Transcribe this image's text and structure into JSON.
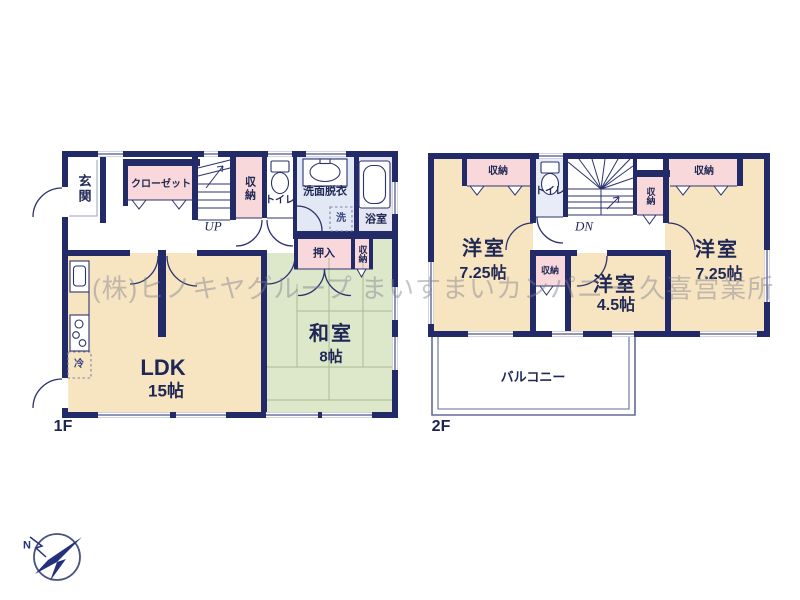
{
  "watermark": "(株)ヒノキヤグループ まいすまいカンパニー 久喜営業所",
  "compass": {
    "north_label": "N"
  },
  "colors": {
    "wall": "#232a68",
    "room_beige": "#f7e5c1",
    "tatami_green": "#dde8cb",
    "closet_pink": "#f8d8da",
    "wet_blue": "#e2e9f4",
    "bath_lavender": "#e5e6f1",
    "balcony_line": "#646b96",
    "watermark_gray": "rgba(125,127,142,0.45)"
  },
  "floor1": {
    "label": "1F",
    "rooms": {
      "genkan": "玄関",
      "closet": "クローゼット",
      "stairs_up": "UP",
      "storage_hall": "収納",
      "toilet": "トイレ",
      "washroom": "洗面脱衣",
      "washer": "洗",
      "bathroom": "浴室",
      "oshiire": "押入",
      "storage_washitsu": "収納",
      "washitsu_name": "和室",
      "washitsu_size": "8帖",
      "ldk_name": "LDK",
      "ldk_size": "15帖",
      "fridge": "冷"
    }
  },
  "floor2": {
    "label": "2F",
    "rooms": {
      "storage_left": "収納",
      "toilet": "トイレ",
      "stairs_down": "DN",
      "storage_mid": "収納",
      "storage_right": "収納",
      "storage_small": "収納",
      "bedroom_left_name": "洋室",
      "bedroom_left_size": "7.25帖",
      "bedroom_right_name": "洋室",
      "bedroom_right_size": "7.25帖",
      "bedroom_small_name": "洋室",
      "bedroom_small_size": "4.5帖",
      "balcony": "バルコニー"
    }
  }
}
